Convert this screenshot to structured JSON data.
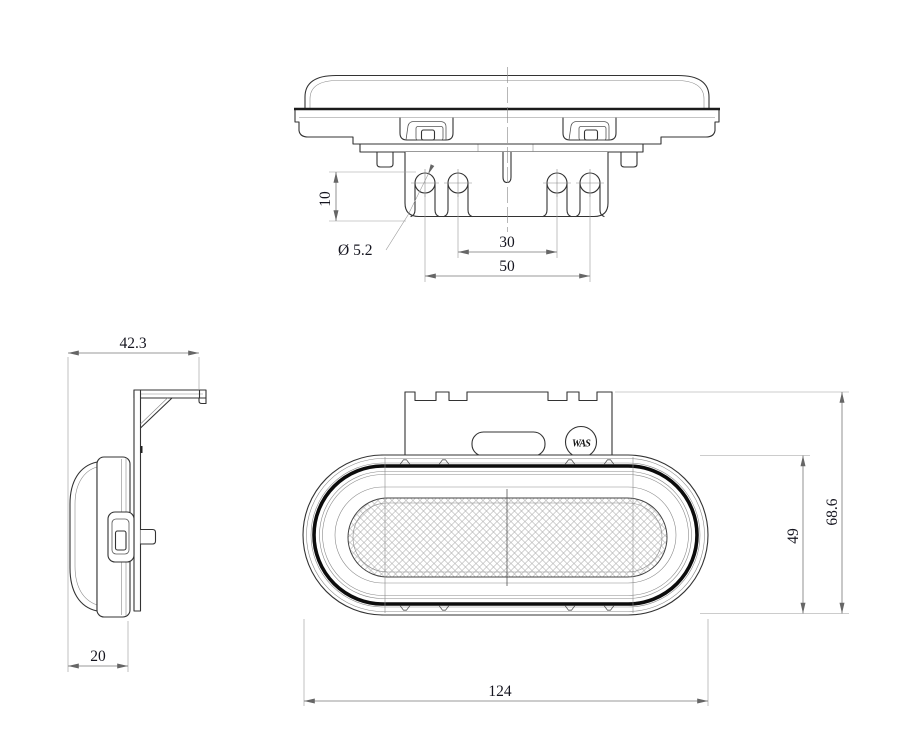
{
  "canvas": {
    "width": 911,
    "height": 756,
    "background": "#ffffff",
    "line_color": "#333333"
  },
  "drawing": {
    "product": "Oval clearance marker lamp with mounting bracket - 3 view technical drawing",
    "logo": {
      "text": "WAS"
    },
    "top_view": {
      "dim_hole_offset": "10",
      "dim_hole_diameter": "Ø 5.2",
      "dim_inner_hole_spacing": "30",
      "dim_outer_hole_spacing": "50"
    },
    "side_view": {
      "dim_overall_depth": "42.3",
      "dim_body_depth": "20"
    },
    "front_view": {
      "dim_lens_height": "49",
      "dim_overall_height": "68.6",
      "dim_overall_width": "124"
    }
  }
}
